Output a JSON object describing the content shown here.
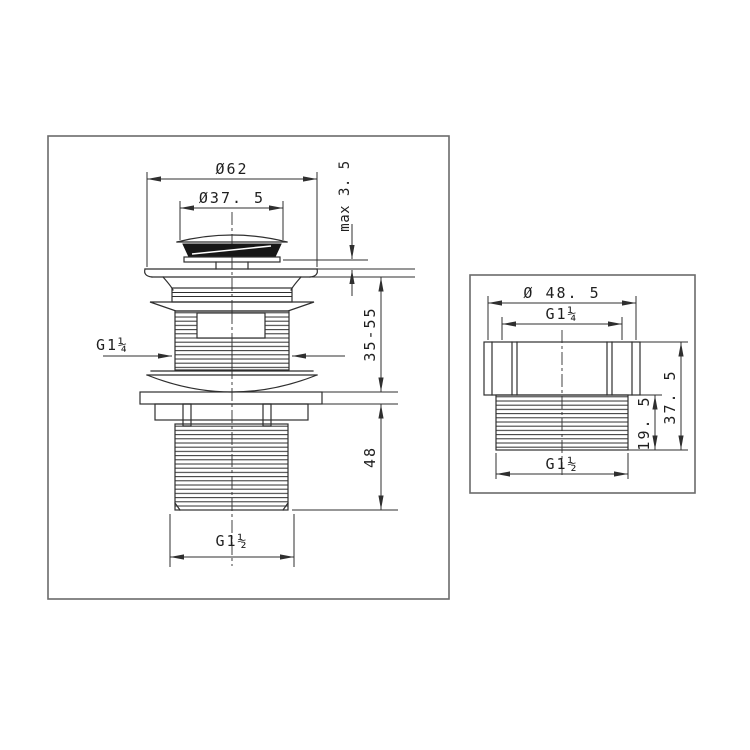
{
  "colors": {
    "background": "#ffffff",
    "drawing_line": "#2f2f2f",
    "panel_border": "#6b6b6b",
    "seal_fill": "#161616"
  },
  "left_drawing": {
    "dim_flange_diameter": "Ø62",
    "dim_cap_diameter": "Ø37. 5",
    "dim_cap_clearance": "max 3. 5",
    "dim_clamping_range": "35-55",
    "dim_tail_thread_length": "48",
    "dim_body_thread": "G1¼",
    "dim_tail_thread": "G1½"
  },
  "right_drawing": {
    "dim_hex_diameter": "Ø 48. 5",
    "dim_top_thread": "G1¼",
    "dim_thread_length": "19. 5",
    "dim_total_height": "37. 5",
    "dim_bottom_thread": "G1½"
  }
}
